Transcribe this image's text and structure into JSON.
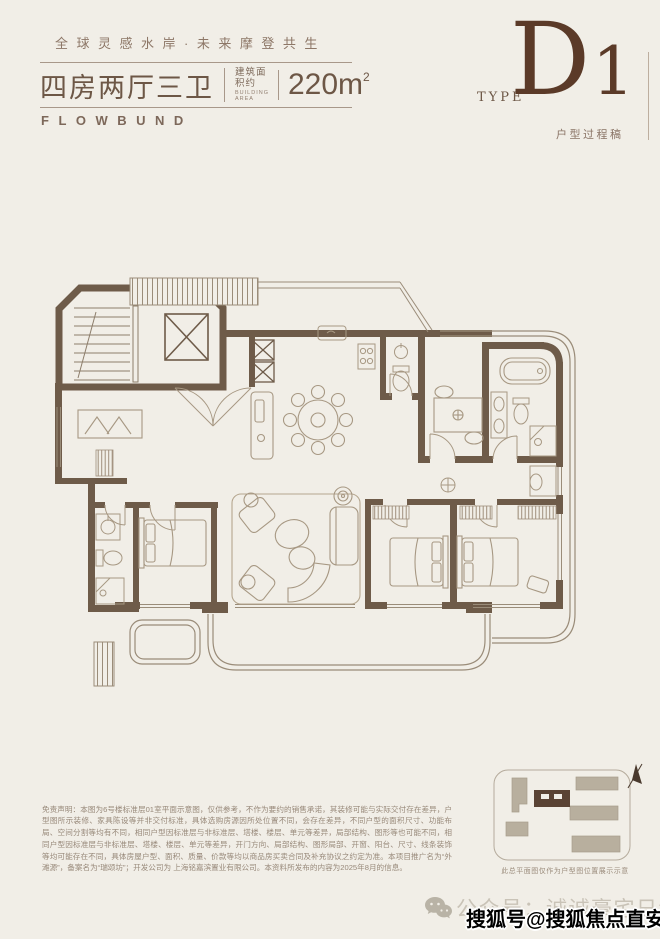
{
  "header": {
    "tagline": "全球灵感水岸·未来摩登共生",
    "title": "四房两厅三卫",
    "area_label_cn": "建筑面积约",
    "area_label_en": "BUILDING AREA",
    "area_value": "220m",
    "area_sup": "2",
    "brand": "FLOWBUND",
    "type_label": "TYPE",
    "type_d": "D",
    "type_one": "1",
    "type_note": "户型过程稿"
  },
  "disclaimer": {
    "text": "免责声明：本图为6号楼标准层01室平面示意图，仅供参考，不作为要约的销售承诺，其装修可能与实际交付存在差异，户型图所示装修、家具陈设等并非交付标准，具体选购房源因所处位置不同，会存在差异，不同户型的面积尺寸、功能布局、空间分割等均有不同，相同户型因标准层与非标准层、塔楼、楼层、单元等差异，局部结构、图形等也可能不同，相同户型因标准层与非标准层、塔楼、楼层、单元等差异，开门方向、局部结构、图形局部、开窗、阳台、尺寸、线条装饰等均可能存在不同，具体房屋户型、面积、质量、价款等均以商品房买卖合同及补充协议之约定为准。本项目推广名为“外滩源”，备案名为“瑞颂坊”；开发公司为 上海铭嘉滨置业有限公司。本资料所发布的内容为2025年8月的信息。"
  },
  "siteplan": {
    "caption": "此总平面图仅作为户型图位置展示示意"
  },
  "footer": {
    "public_account": "公众号：诚诚豪宅日记",
    "watermark": "搜狐号@搜狐焦点直安店"
  },
  "colors": {
    "background": "#f1eee7",
    "wall": "#6e5b49",
    "furniture_line": "#a79883",
    "accent_brown": "#5b3a28",
    "text_brown": "#6d5746"
  }
}
